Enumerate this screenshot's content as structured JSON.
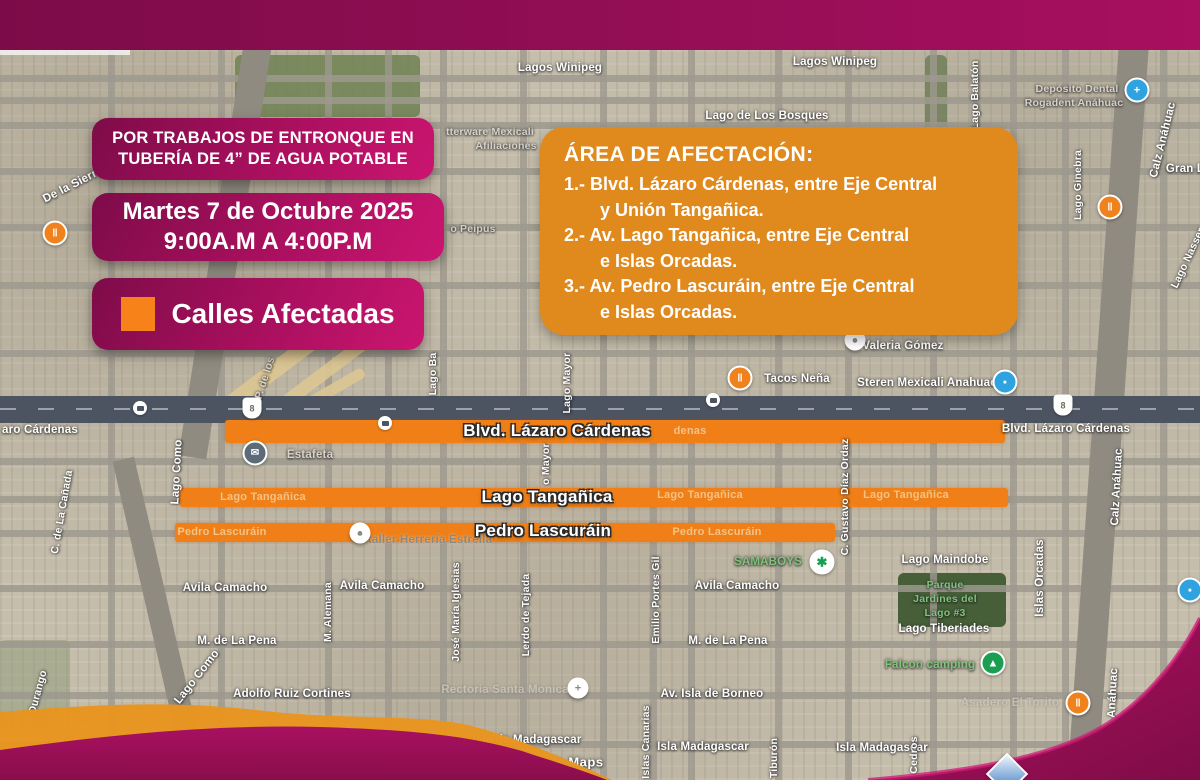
{
  "notice_box": {
    "line1": "POR TRABAJOS DE ENTRONQUE EN",
    "line2": "TUBERÍA DE 4” DE AGUA POTABLE"
  },
  "schedule_box": {
    "line1": "Martes 7 de Octubre 2025",
    "line2": "9:00A.M A 4:00P.M"
  },
  "legend_box": {
    "label": "Calles Afectadas"
  },
  "affected_area": {
    "title": "ÁREA DE AFECTACIÓN:",
    "items": [
      {
        "l1": "1.- Blvd. Lázaro Cárdenas, entre Eje Central",
        "l2": "y Unión Tangañica."
      },
      {
        "l1": "2.- Av. Lago Tangañica, entre Eje Central",
        "l2": "e Islas Orcadas."
      },
      {
        "l1": "3.- Av. Pedro Lascuráin, entre Eje Central",
        "l2": "e Islas Orcadas."
      }
    ]
  },
  "street_overlays": {
    "blvd": "Blvd. Lázaro Cárdenas",
    "tang": "Lago Tangañica",
    "lasc": "Pedro Lascuráin"
  },
  "colors": {
    "magenta_dark": "#7c0c49",
    "magenta_bright": "#cb1570",
    "panel_orange": "#e0891c",
    "street_orange": "#ef7f16",
    "legend_orange": "#f8821a"
  },
  "map": {
    "watermark": "Google Maps",
    "labels": {
      "lagos_winipeg_1": "Lagos Winipeg",
      "lagos_winipeg_2": "Lagos Winipeg",
      "lago_bosques": "Lago de Los Bosques",
      "tupperware_1": "tterware Mexicali",
      "tupperware_2": "Afiliaciones",
      "deposito_1": "Depósito Dental",
      "deposito_2": "Rogadent Anáhuac",
      "gran_l": "Gran L",
      "lago_balaton": "Lago Balatón",
      "lago_ginebra": "Lago Ginebra",
      "calz_anahuac_top": "Calz Anáhuac",
      "lago_nasser": "Lago Nasser",
      "de_la_sierra": "De la Sierra",
      "wing_go": "Wing Go",
      "o_peipus": "o Peipus",
      "valeria": "Valeria Gómez",
      "tacos": "Tacos Neña",
      "steren": "Steren Mexicali Anahuac",
      "blvd_map_right": "Blvd. Lázaro Cárdenas",
      "aro_cardenas": "aro Cárdenas",
      "denas": "denas",
      "estafeta": "Estafeta",
      "p_de_los": "P. de los",
      "lago_ba": "Lago Ba",
      "lago_mayor": "Lago Mayor",
      "o_mayor": "o Mayor",
      "lago_como_1": "Lago Como",
      "lago_como_2": "Lago Como",
      "canada": "C. de La Cañada",
      "durango": "Durango",
      "taller": "taller Herrería Estrella",
      "gustavo": "C. Gustavo Díaz Ordaz",
      "islas_orcadas": "Islas Orcadas",
      "calz_anahuac_mid": "Calz Anáhuac",
      "anahuac_bottom": "Anáhuac",
      "samaboys": "SAMABOYS",
      "avila_1": "Avila Camacho",
      "avila_2": "Avila Camacho",
      "avila_3": "Avila Camacho",
      "pena_1": "M. de La Pena",
      "pena_2": "M. de La Pena",
      "alemana": "M. Alemana",
      "iglesias": "José María Iglesias",
      "lerdo": "Lerdo de Tejada",
      "portes": "Emilio Portes Gil",
      "ruiz": "Adolfo Ruiz Cortines",
      "rectoria": "Rectoria Santa Monica",
      "borneo": "Av. Isla de Borneo",
      "madagascar_1": "Isla de Madagascar",
      "madagascar_2": "Isla Madagascar",
      "madagascar_3": "Isla Madagascar",
      "canarias": "Islas Canarias",
      "tiburon": "Tiburón",
      "cedros": "Cedros",
      "asadero": "Asadero El Torito",
      "maindobe": "Lago Maindobe",
      "parque_1": "Parque",
      "parque_2": "Jardines del",
      "parque_3": "Lago #3",
      "tiberiades": "Lago Tiberiades",
      "falcon": "Falcon camping",
      "tang_grey_1": "Lago Tangañica",
      "tang_grey_2": "Lago Tangañica",
      "tang_grey_3": "Lago Tangañica",
      "lasc_grey_1": "Pedro Lascuráin",
      "lasc_grey_2": "Pedro Lascuráin"
    }
  }
}
